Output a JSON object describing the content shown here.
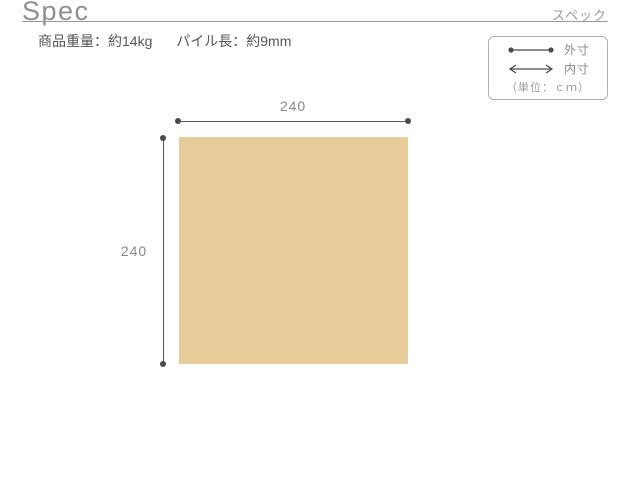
{
  "header": {
    "title": "Spec",
    "subtitle": "スペック"
  },
  "specs": {
    "items": [
      "商品重量：約14kg",
      "パイル長：約9mm"
    ]
  },
  "legend": {
    "outer_label": "外寸",
    "inner_label": "内寸",
    "unit_label": "（単位：ｃｍ）"
  },
  "diagram": {
    "shape": "square-rug",
    "width_label": "240",
    "height_label": "240"
  },
  "colors": {
    "rug_fill": "#e5cc98",
    "dimension_line": "#5a5a5a",
    "label_text": "#888888",
    "divider": "#9a9a9a"
  }
}
